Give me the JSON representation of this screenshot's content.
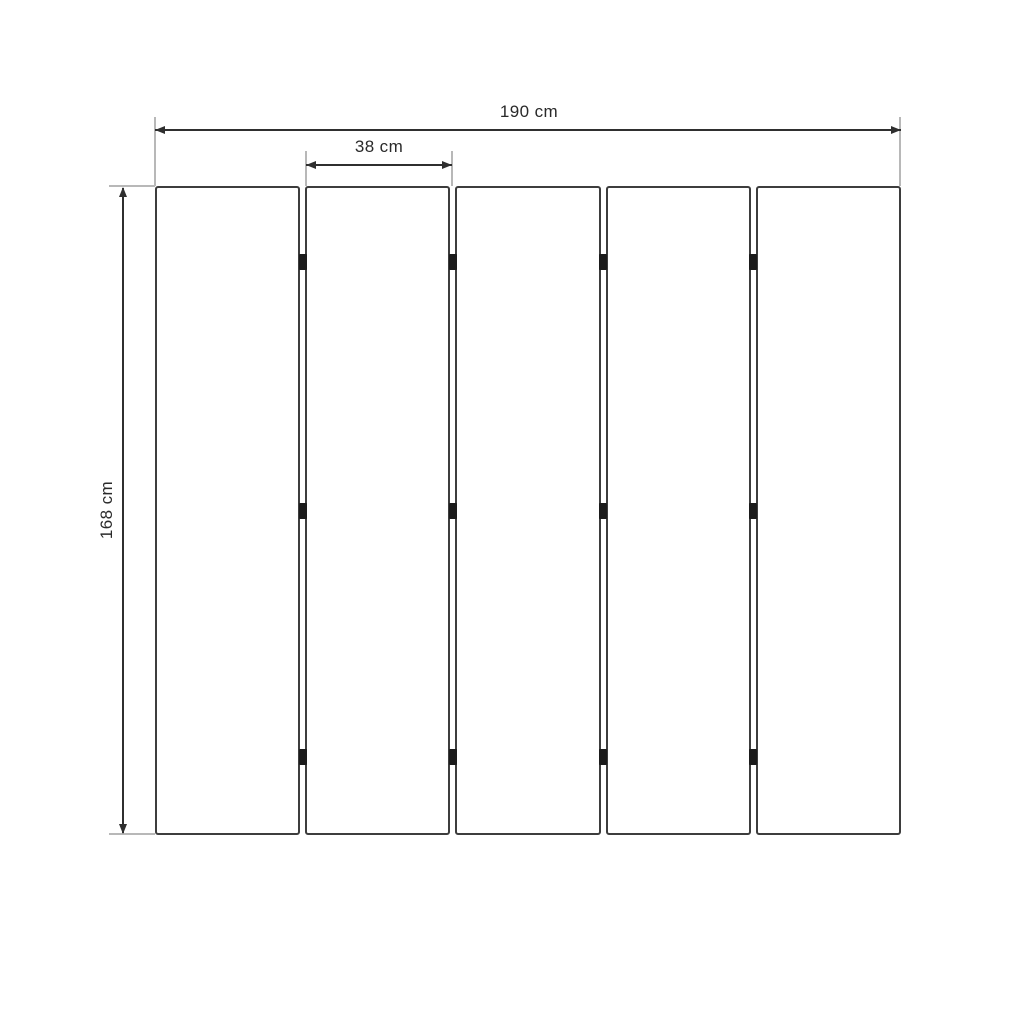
{
  "diagram": {
    "panel_count": 5,
    "hinge_rows_per_gap": 3,
    "dimensions": {
      "total_width": "190 cm",
      "panel_width": "38 cm",
      "panel_height": "168 cm"
    },
    "colors": {
      "background": "#ffffff",
      "panel_border": "#3d3d3d",
      "dimension_line": "#2f2f2f",
      "extension_line": "#b8b8b8",
      "hinge": "#1b1b1b",
      "label_text": "#2a2a2a"
    }
  }
}
